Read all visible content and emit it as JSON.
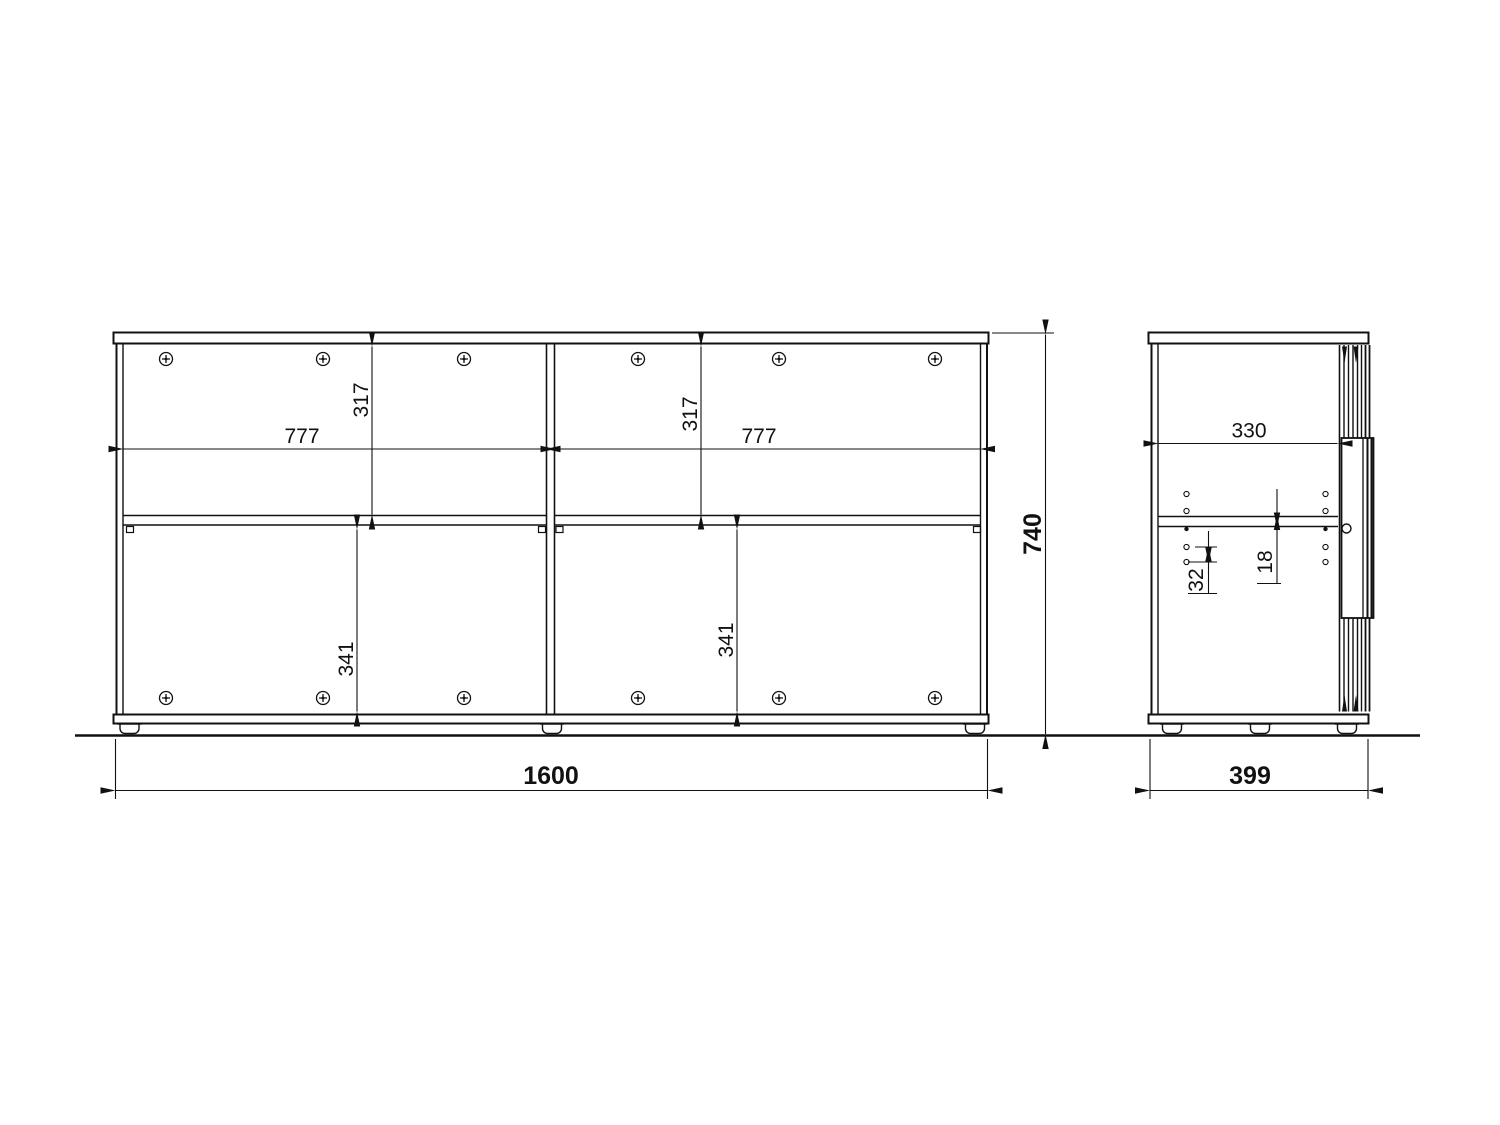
{
  "front_view": {
    "overall_width": "1600",
    "overall_height": "740",
    "left_bay": {
      "width": "777",
      "upper_height": "317",
      "lower_height": "341"
    },
    "right_bay": {
      "width": "777",
      "upper_height": "317",
      "lower_height": "341"
    }
  },
  "side_view": {
    "overall_depth": "399",
    "inner_depth": "330",
    "shelf_thickness": "18",
    "hole_spacing": "32"
  }
}
